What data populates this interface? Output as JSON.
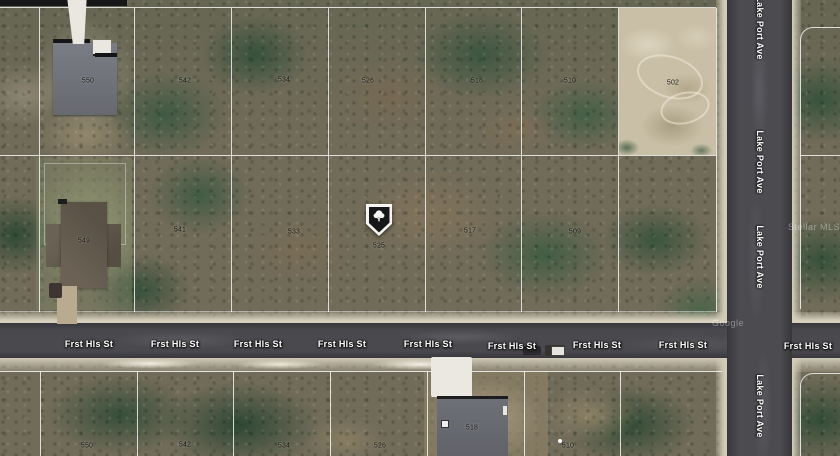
{
  "map": {
    "type": "satellite-parcel-view",
    "streets": {
      "horizontal": "Frst Hls St",
      "vertical": "Lake Port Ave"
    },
    "lots": {
      "top_row": [
        "542",
        "534",
        "526",
        "518",
        "510",
        "502"
      ],
      "top_left_house": "550",
      "middle_row": [
        "549",
        "541",
        "533",
        "517",
        "509"
      ],
      "marker_lot": "525",
      "bottom_row": [
        "550",
        "542",
        "534",
        "526",
        "510"
      ],
      "bottom_house": "518"
    },
    "marker": {
      "icon": "tree-pin-icon",
      "color": "#17171a"
    },
    "colors": {
      "road": "#4a494e",
      "shoulder": "#d2cbb7",
      "parcel_line": "#ffffff",
      "sand_parcel": "#c9bfa6"
    },
    "watermarks": {
      "mls": "Stellar MLS",
      "imagery": "Google"
    }
  }
}
